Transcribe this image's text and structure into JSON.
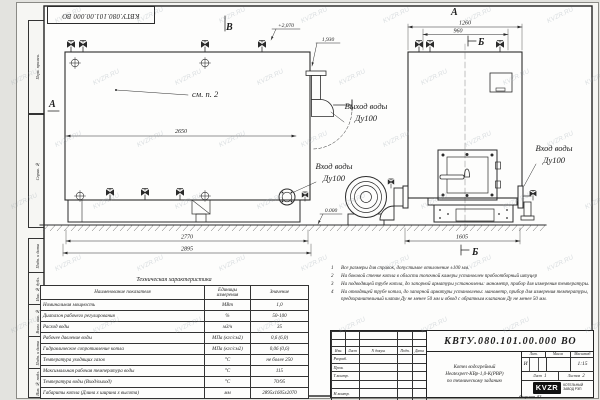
{
  "watermark": {
    "text": "KVZR.RU"
  },
  "frame": {
    "top_stamp": "КВТУ.080.101.00.000  ВО",
    "left_labels": [
      "Перв. примен.",
      "Справ. №",
      "Подп. и дата",
      "Инв. № дубл.",
      "Взам. инв. №",
      "Подп. и дата",
      "Инв. № подл."
    ],
    "format_note": "Формат  А3"
  },
  "drawing": {
    "side_view": {
      "view_letter_top": "В",
      "section_letter_left": "А",
      "callout": "см. п. 2",
      "elevation_top": "+2,070",
      "elevation_outlet": "1,930",
      "elevation_zero": "0.000",
      "dim_width": "2650",
      "dim_base": "2770",
      "dim_overall": "2895",
      "outlet_line1": "Выход воды",
      "outlet_line2": "Ду100",
      "inlet_line1": "Вход воды",
      "inlet_line2": "Ду100"
    },
    "front_view": {
      "view_letter_top": "А",
      "section_letter_top": "Б",
      "section_letter_bottom": "Б",
      "dim_overall": "1260",
      "dim_inner": "960",
      "dim_base": "1605",
      "inlet_line1": "Вход воды",
      "inlet_line2": "Ду100"
    }
  },
  "notes": [
    {
      "num": "1",
      "text": "Все размеры для справок, допустимое отклонение ±100 мм."
    },
    {
      "num": "2",
      "text": "На боковой стенке котла в области топочной камеры установлен пробоотборный штуцер"
    },
    {
      "num": "3",
      "text": "На подводящей трубе котла, до запорной арматуры установлены: манометр, прибор для измерения температуры."
    },
    {
      "num": "4",
      "text": "На отводящей трубе котла, до запорной арматуры установлены: манометр, прибор для измерения температуры, предохранительный клапан Ду не менее 50 мм и обвод с обратным клапаном Ду не менее 50 мм."
    }
  ],
  "spec_table": {
    "title": "Техническая характеристика",
    "headers": [
      "Наименование показателя",
      "Единицы измерения",
      "Значение"
    ],
    "rows": [
      [
        "Номинальная мощность",
        "МВт",
        "1,0"
      ],
      [
        "Диапазон рабочего регулирования",
        "%",
        "50-100"
      ],
      [
        "Расход воды",
        "м3/ч",
        "35"
      ],
      [
        "Рабочее давление воды",
        "МПа (кгс/см2)",
        "0,6 (6,0)"
      ],
      [
        "Гидравлическое сопротивление котла",
        "МПа (кгс/см2)",
        "0,06 (0,6)"
      ],
      [
        "Температура уходящих газов",
        "°С",
        "не более 250"
      ],
      [
        "Максимальная рабочая температура воды",
        "°С",
        "115"
      ],
      [
        "Температура воды (Вход/выход)",
        "°С",
        "70/95"
      ],
      [
        "Габариты котла (Длина х ширина х высота)",
        "мм",
        "2895х1605х2070"
      ]
    ]
  },
  "title_block": {
    "designation": "КВТУ.080.101.00.000  ВО",
    "doc_name_lines": [
      "Котел водогрейный",
      "Heatexpert-КВр-1,0-К(РВР)",
      "по техническому заданию"
    ],
    "header_cols": [
      "Изм.",
      "Лист",
      "N докум.",
      "Подп.",
      "Дата"
    ],
    "row_labels": [
      "Разраб.",
      "Пров.",
      "Т.контр.",
      "",
      "Н.контр.",
      "Утв."
    ],
    "lit_header": "Лит.",
    "mass_header": "Масса",
    "scale_header": "Масштаб",
    "lit_value": "И",
    "scale_value": "1:15",
    "sheet_label": "Лист",
    "sheet_value": "1",
    "sheets_label": "Листов",
    "sheets_value": "2",
    "logo_text": "KVZR",
    "logo_caption_1": "КОТЕЛЬНЫЙ",
    "logo_caption_2": "ЗАВОД РЭП"
  }
}
